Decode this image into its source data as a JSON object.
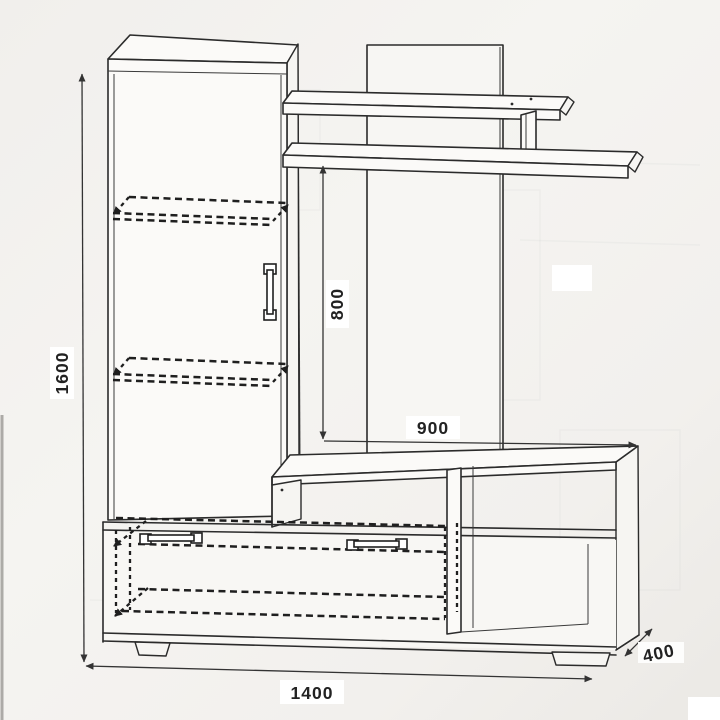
{
  "figure": {
    "kind": "furniture technical drawing (wall unit / TV stand)",
    "background": "#f3f1ee",
    "line_color": "#2b2b2b",
    "label_bg": "#ffffff",
    "text_color": "#222222"
  },
  "dimensions": {
    "overall_height": "1600",
    "niche_height": "800",
    "niche_width": "900",
    "overall_width": "1400",
    "depth": "400"
  }
}
